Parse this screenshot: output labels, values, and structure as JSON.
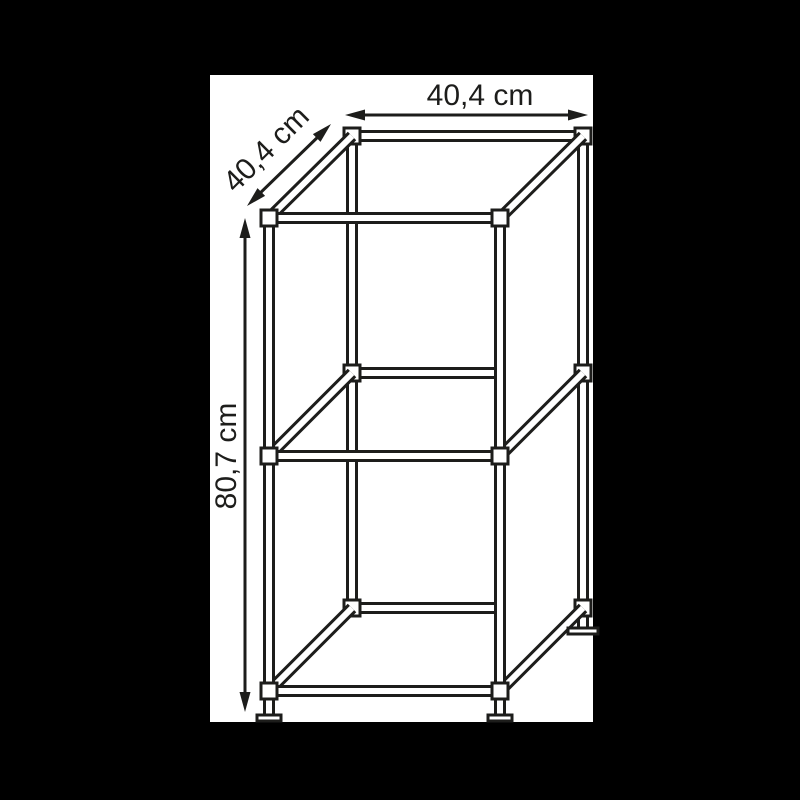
{
  "scene": {
    "background_color": "#000000",
    "canvas_color": "#ffffff",
    "line_color": "#1d1d1b"
  },
  "diagram": {
    "labels": {
      "width": "40,4 cm",
      "depth": "40,4 cm",
      "height": "80,7 cm"
    },
    "dimensions_cm": {
      "width": 40.4,
      "depth": 40.4,
      "height": 80.7
    },
    "unit": "cm"
  }
}
